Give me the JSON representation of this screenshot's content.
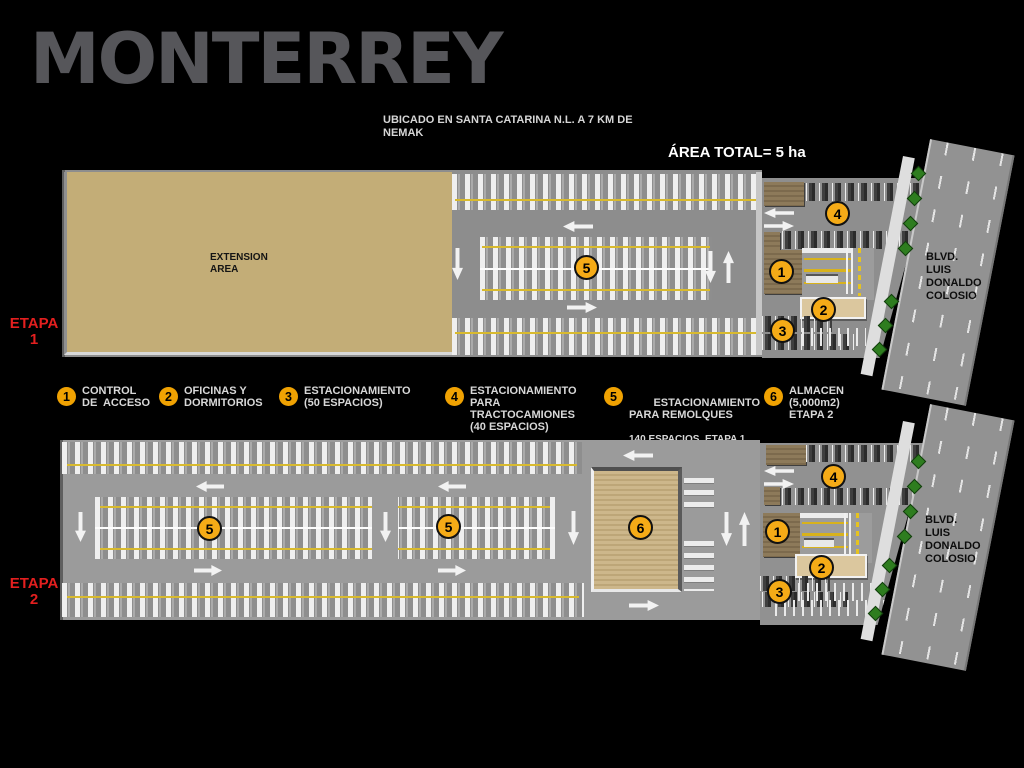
{
  "title": "MONTERREY",
  "subtitle": "UBICADO EN SANTA CATARINA N.L. A 7 KM DE\nNEMAK",
  "area_total": "ÁREA TOTAL= 5 ha",
  "etapa1": {
    "stage_label": "ETAPA\n1",
    "extension_area_label": "EXTENSION\nAREA",
    "boulevard_label": "BLVD.\nLUIS\nDONALDO\nCOLOSIO",
    "markers": {
      "trailers": "5",
      "tractors": "4",
      "access": "1",
      "offices": "2",
      "cars": "3"
    }
  },
  "etapa2": {
    "stage_label": "ETAPA\n2",
    "boulevard_label": "BLVD.\nLUIS\nDONALDO\nCOLOSIO",
    "markers": {
      "trailers_a": "5",
      "trailers_b": "5",
      "warehouse": "6",
      "tractors": "4",
      "access": "1",
      "offices": "2",
      "cars": "3"
    }
  },
  "legend": {
    "items": [
      {
        "num": "1",
        "text": "CONTROL\nDE  ACCESO"
      },
      {
        "num": "2",
        "text": "OFICINAS Y\nDORMITORIOS"
      },
      {
        "num": "3",
        "text": "ESTACIONAMIENTO\n(50 ESPACIOS)"
      },
      {
        "num": "4",
        "text": "ESTACIONAMIENTO\nPARA\nTRACTOCAMIONES\n(40 ESPACIOS)"
      },
      {
        "num": "5",
        "text": "ESTACIONAMIENTO\nPARA REMOLQUES",
        "sub": "140 ESPACIOS  ETAPA 1\n280 ESPACIOS  ETAPA 2"
      },
      {
        "num": "6",
        "text": "ALMACEN\n(5,000m2)\nETAPA 2"
      }
    ]
  },
  "colors": {
    "background": "#000000",
    "title_gray": "#56565a",
    "stage_red": "#e31f1f",
    "marker_orange": "#f5ab17",
    "extension_tan": "#c3ad77",
    "lot_gray": "#8d8d8d",
    "road_gray": "#929292",
    "tree_green": "#2e7d1f"
  }
}
